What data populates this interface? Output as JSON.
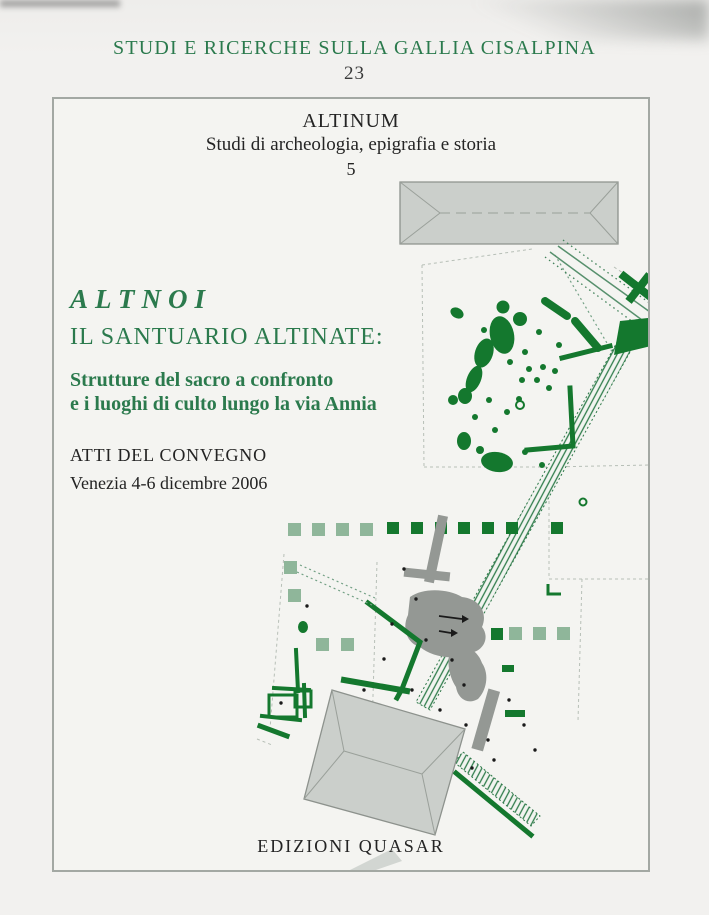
{
  "series": {
    "title": "STUDI E RICERCHE SULLA GALLIA CISALPINA",
    "number": "23"
  },
  "collection": {
    "name": "ALTINUM",
    "subtitle": "Studi di archeologia, epigrafia e storia",
    "number": "5"
  },
  "book": {
    "title_latin": "ALTNOI",
    "title": "IL SANTUARIO ALTINATE:",
    "subtitle_line1": "Strutture del sacro a confronto",
    "subtitle_line2": "e i luoghi di culto lungo la via Annia"
  },
  "event": {
    "type": "ATTI DEL CONVEGNO",
    "venue_date": "Venezia 4-6 dicembre 2006"
  },
  "publisher": {
    "name": "EDIZIONI QUASAR"
  },
  "colors": {
    "green_text": "#2b7a4d",
    "map_green": "#14782e",
    "map_light_green": "#8fb69a",
    "map_gray": "#949894",
    "roof_gray": "#cbcfcb"
  }
}
